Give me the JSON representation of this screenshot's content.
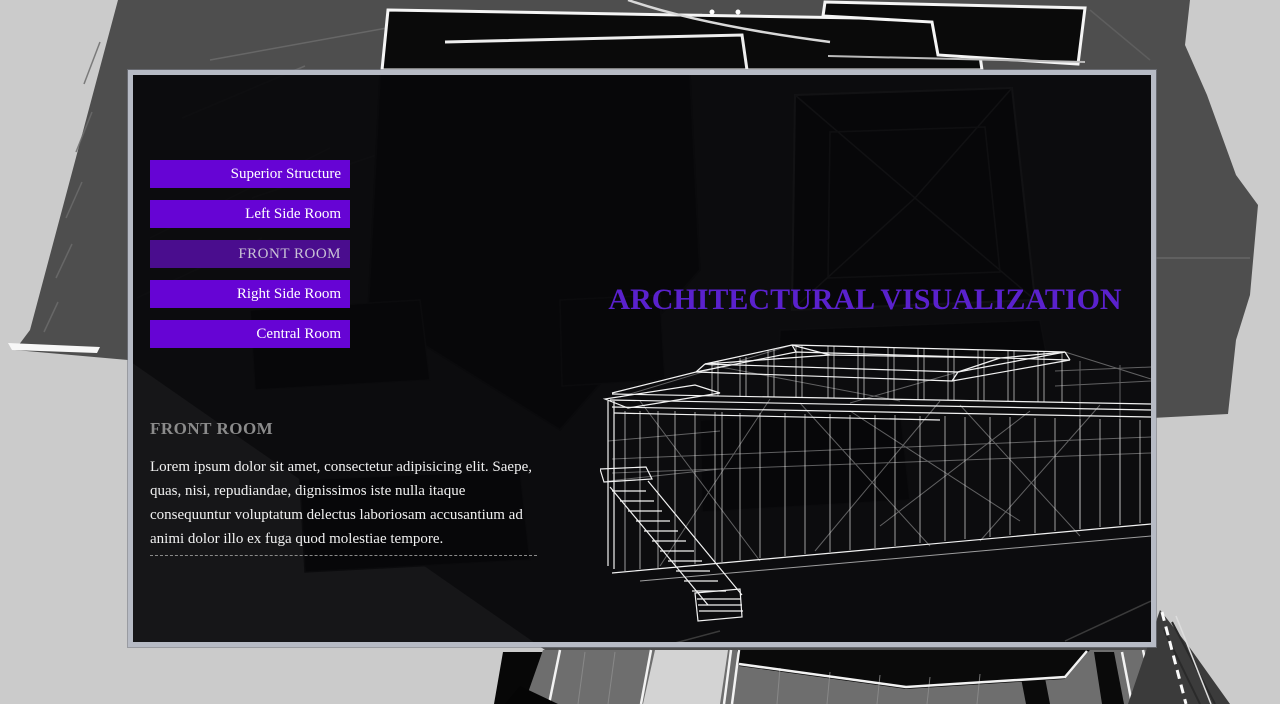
{
  "overlay_title": {
    "text": "ARCHITECTURAL VISUALIZATION",
    "color": "#5a21cd"
  },
  "nav": {
    "buttons": [
      {
        "label": "Superior Structure",
        "active": false
      },
      {
        "label": "Left Side Room",
        "active": false
      },
      {
        "label": "FRONT ROOM",
        "active": true
      },
      {
        "label": "Right Side Room",
        "active": false
      },
      {
        "label": "Central Room",
        "active": false
      }
    ],
    "colors": {
      "normal": "#6604d4",
      "active": "#4a0d8e",
      "text": "#ffffff",
      "active_text": "#c9c2d6"
    }
  },
  "section": {
    "heading": "FRONT ROOM",
    "heading_color": "#8b8b8b",
    "body": "Lorem ipsum dolor sit amet, consectetur adipisicing elit. Saepe, quas, nisi, repudiandae, dignissimos iste nulla itaque consequuntur voluptatum delectus laboriosam accusantium ad animi dolor illo ex fuga quod molestiae tempore."
  },
  "graphics": {
    "scene": "3d-architectural-render-background",
    "model": "wireframe-house-model"
  },
  "colors": {
    "page_bg": "#cbcbcb",
    "scene_gray": "#4e4e4e",
    "panel_border": "#b7bbc5",
    "panel_bg": "rgba(8,7,10,0.93)"
  }
}
